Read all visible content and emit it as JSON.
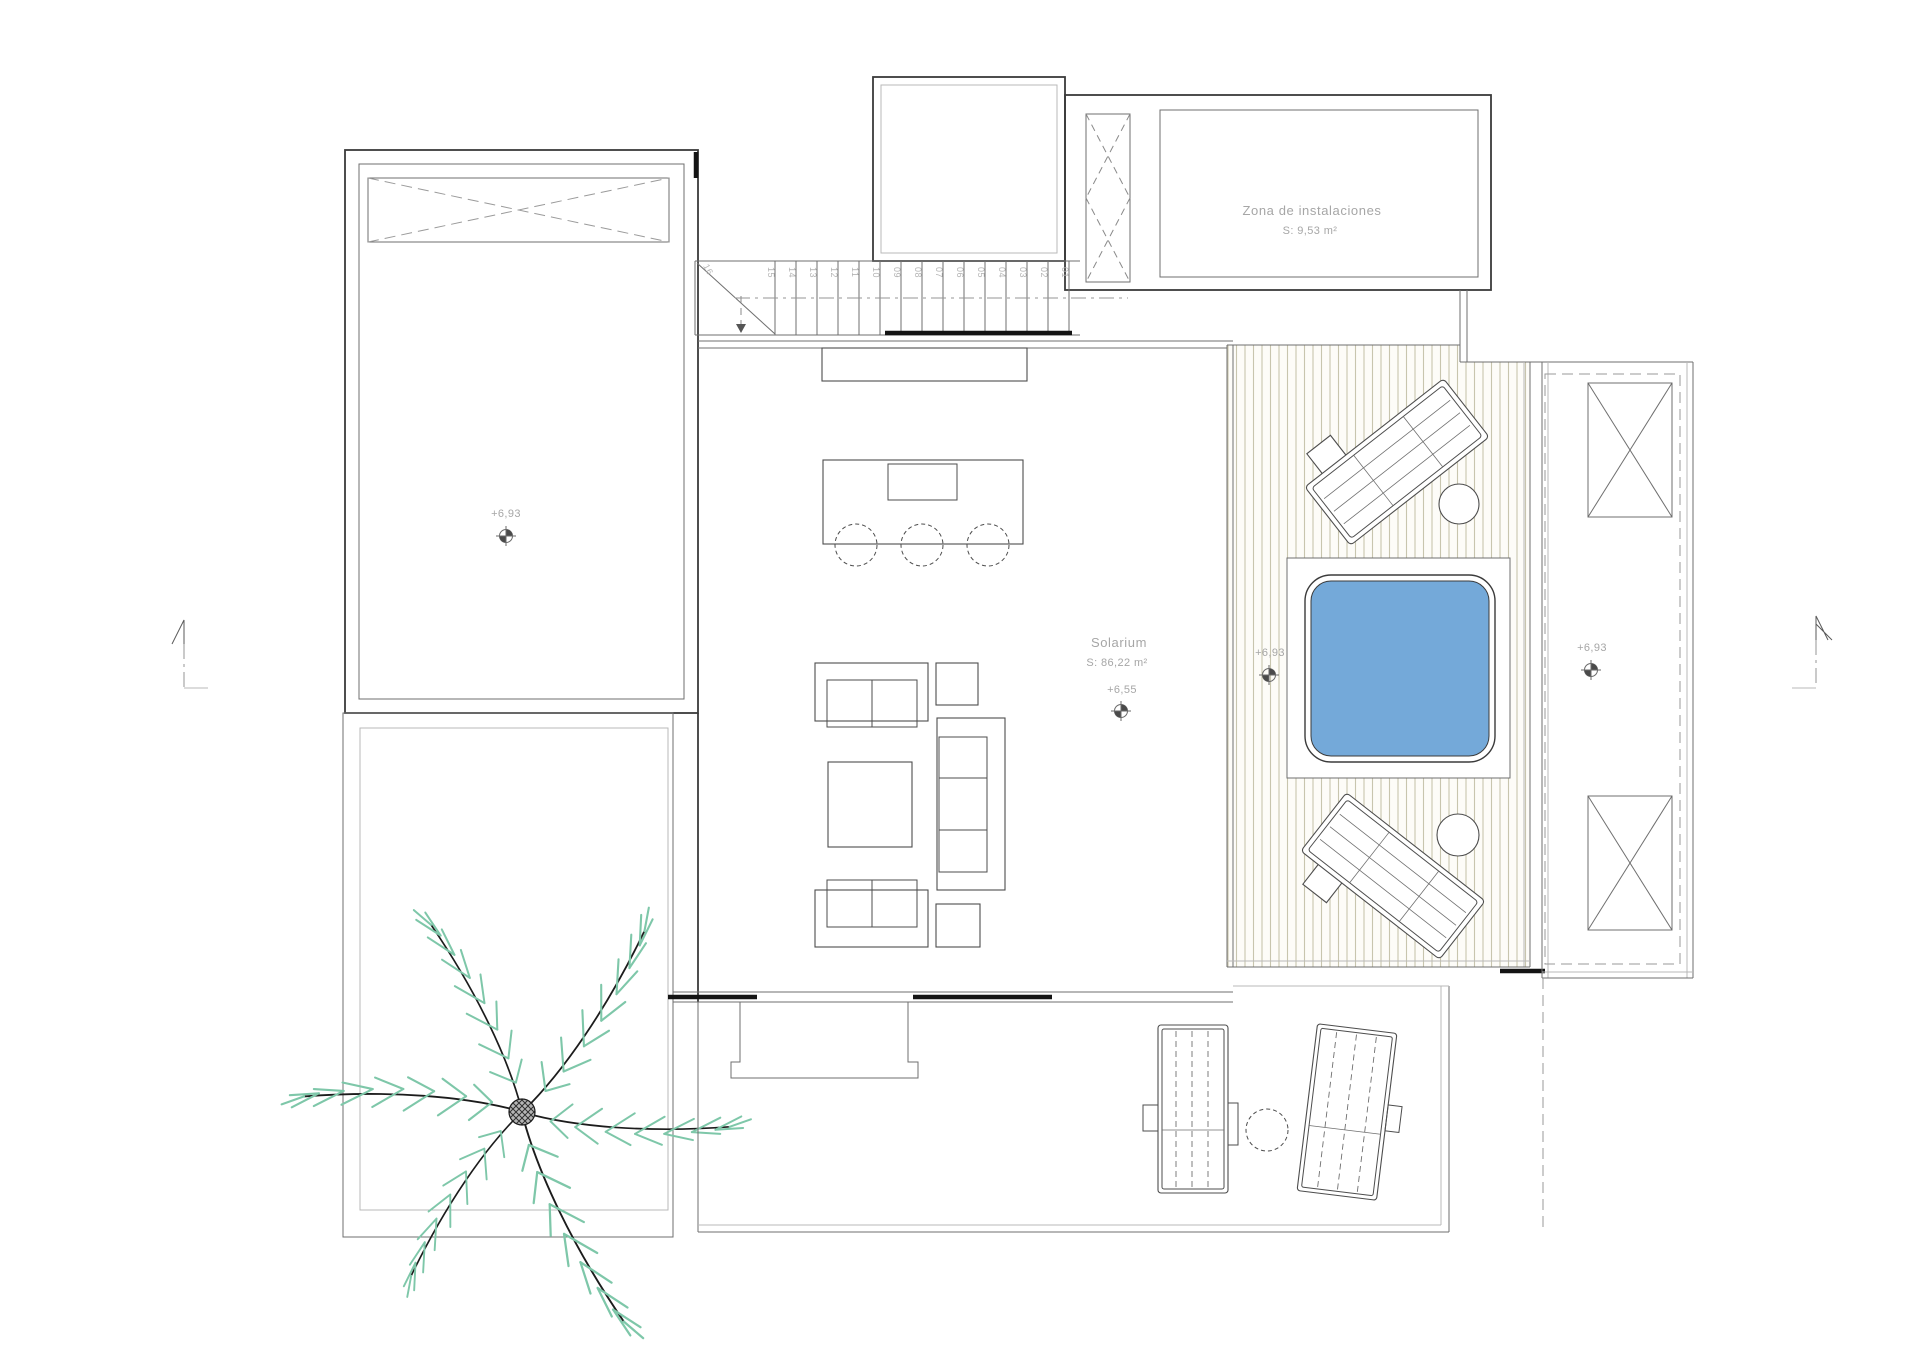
{
  "document": {
    "type": "architectural floor plan",
    "view": "roof terrace / solarium level"
  },
  "labels": {
    "instalaciones": {
      "name": "Zona de instalaciones",
      "area": "S: 9,53 m²"
    },
    "solarium": {
      "name": "Solarium",
      "area": "S: 86,22 m²",
      "level": "+6,55"
    },
    "left_roof_level": "+6,93",
    "deck_level": "+6,93",
    "right_roof_level": "+6,93"
  },
  "stairs": {
    "steps": [
      "01",
      "02",
      "03",
      "04",
      "05",
      "06",
      "07",
      "08",
      "09",
      "10",
      "11",
      "12",
      "13",
      "14",
      "15",
      "16"
    ]
  },
  "colors": {
    "pool_water": "#74a9d9",
    "palm_leaf": "#7ec7a9",
    "deck_stripe": "#c8c5ae",
    "wall_line": "#3b3b3b",
    "label_text": "#a6a6a6"
  }
}
